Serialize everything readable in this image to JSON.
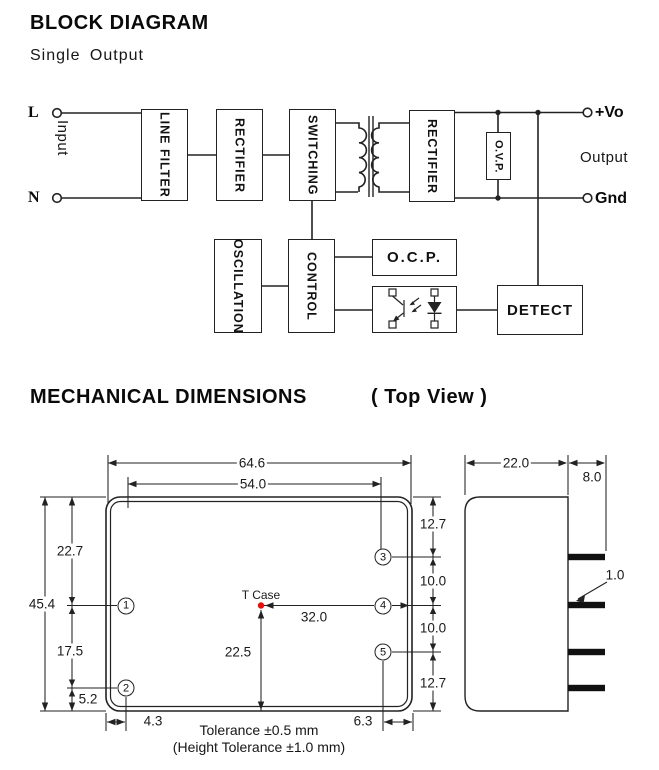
{
  "block_diagram": {
    "title": "BLOCK DIAGRAM",
    "subtitle": "Single Output",
    "input_label": "Input",
    "output_label": "Output",
    "terminals": {
      "line": "L",
      "neutral": "N",
      "vout": "+Vo",
      "gnd": "Gnd"
    },
    "blocks": {
      "line_filter": "LINE FILTER",
      "rectifier_in": "RECTIFIER",
      "switching": "SWITCHING",
      "rectifier_out": "RECTIFIER",
      "ovp": "O.V.P.",
      "oscillation": "OSCILLATION",
      "control": "CONTROL",
      "ocp": "O.C.P.",
      "detect": "DETECT"
    },
    "icons": {
      "transformer": "transformer-symbol",
      "optocoupler": "optocoupler-symbol"
    }
  },
  "mechanical": {
    "title": "MECHANICAL DIMENSIONS",
    "view_label": "( Top View )",
    "t_case_label": "T Case",
    "tolerance_line1": "Tolerance ±0.5 mm",
    "tolerance_line2": "(Height Tolerance ±1.0 mm)",
    "pin_labels": {
      "p1": "1",
      "p2": "2",
      "p3": "3",
      "p4": "4",
      "p5": "5"
    },
    "dims": {
      "case_width": "64.6",
      "pin_span_x": "54.0",
      "top_to_pin1": "22.7",
      "case_height": "45.4",
      "pin1_to_pin2": "17.5",
      "pin2_to_bottom": "5.2",
      "edge_to_pin_left": "4.3",
      "top_to_pin3": "12.7",
      "pin3_to_pin4": "10.0",
      "pin4_to_pin5": "10.0",
      "pin5_to_bottom": "12.7",
      "pin_to_edge_right": "6.3",
      "tcase_to_right_edge": "32.0",
      "tcase_to_bottom": "22.5",
      "case_depth": "22.0",
      "pin_length": "8.0",
      "pin_thickness": "1.0"
    },
    "colors": {
      "t_case_dot": "#e8100c",
      "line_color": "#222222"
    }
  }
}
